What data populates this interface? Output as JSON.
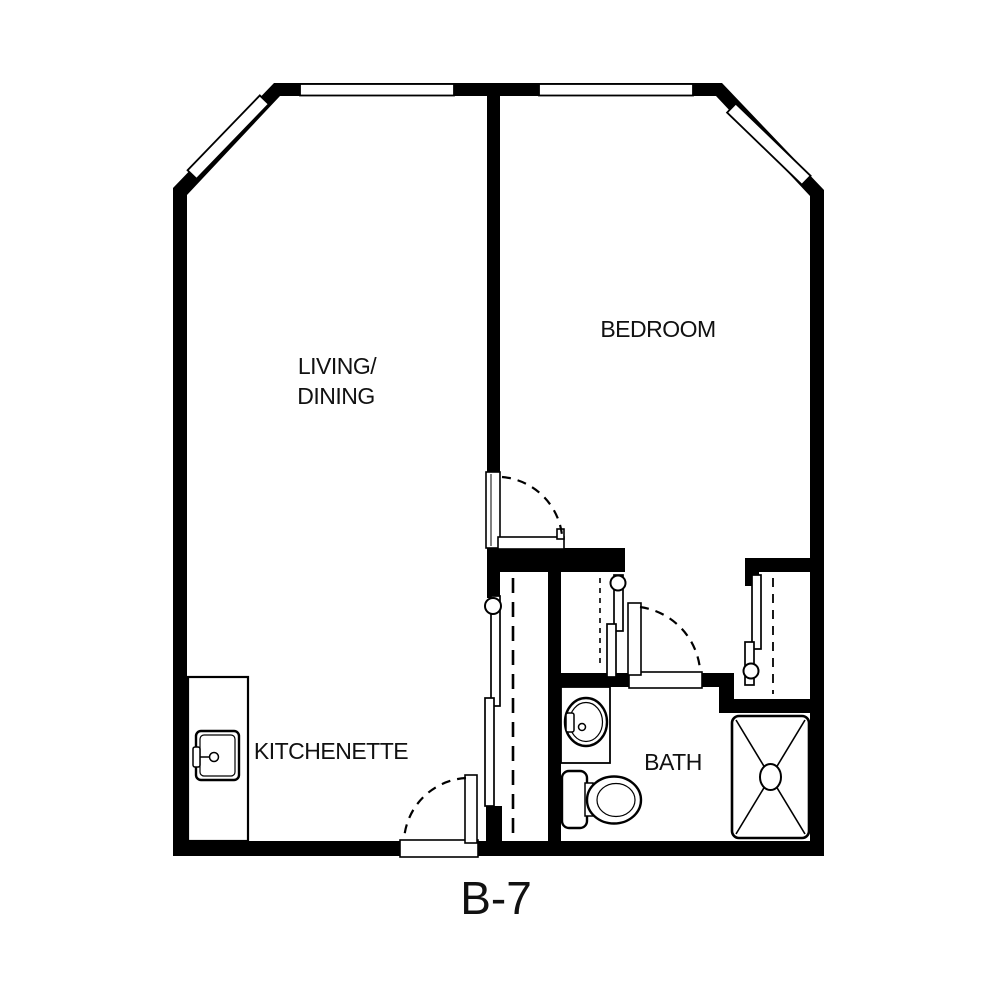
{
  "plan": {
    "id_label": "B-7",
    "colors": {
      "wall": "#000000",
      "background": "#ffffff",
      "text": "#111111"
    },
    "rooms": {
      "living_dining": {
        "line1": "LIVING/",
        "line2": "DINING"
      },
      "bedroom": {
        "label": "BEDROOM"
      },
      "kitchenette": {
        "label": "KITCHENETTE"
      },
      "bath": {
        "label": "BATH"
      }
    },
    "features": {
      "windows": [
        "top-wall-window-left",
        "top-wall-window-right",
        "chamfer-window-left",
        "chamfer-window-right"
      ],
      "doors": [
        "entry-door",
        "bedroom-door",
        "bath-door"
      ],
      "closets": [
        "living-closet",
        "hall-closet",
        "bedroom-closet"
      ],
      "fixtures": [
        "kitchen-sink",
        "kitchen-counter",
        "bath-vanity",
        "bath-sink",
        "toilet",
        "shower"
      ]
    }
  }
}
